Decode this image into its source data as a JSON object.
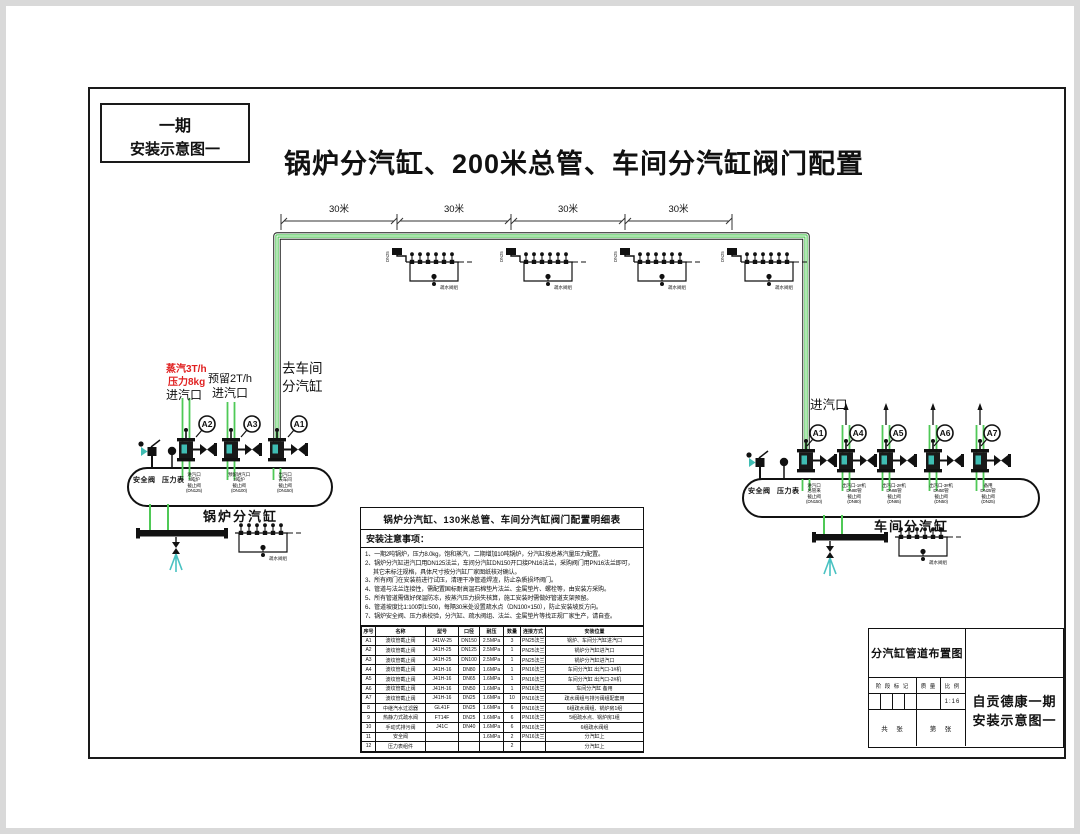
{
  "page": {
    "phase_box": {
      "line1": "一期",
      "line2": "安装示意图一"
    },
    "main_title": "锅炉分汽缸、200米总管、车间分汽缸阀门配置"
  },
  "colors": {
    "pipe_green": "#4fc956",
    "pipe_light": "#eef9ee",
    "teal": "#3fbdb3",
    "red": "#e02020",
    "line": "#1a1a1a"
  },
  "main_pipe": {
    "segments": [
      "30米",
      "30米",
      "30米",
      "30米"
    ],
    "tap_dn": "DN25",
    "trap_label": "疏水阀组"
  },
  "boiler_drum": {
    "label": "锅炉分汽缸",
    "safety_valve": "安全阀",
    "pressure_gauge": "压力表",
    "inlet1": {
      "red1": "蒸汽3T/h",
      "red2": "压力8kg",
      "label": "进汽口",
      "valve_tag": "A2"
    },
    "inlet2": {
      "line1": "预留2T/h",
      "line2": "进汽口",
      "valve_tag": "A3"
    },
    "outlet": {
      "line1": "去车间",
      "line2": "分汽缸",
      "valve_tag": "A1"
    },
    "nozzles": [
      [
        "进汽口",
        "3吨炉",
        "截止阀",
        "(DN125)"
      ],
      [
        "预留进汽口",
        "2吨炉",
        "截止阀",
        "(DN100)"
      ],
      [
        "出汽口",
        "去车间",
        "截止阀",
        "(DN150)"
      ]
    ],
    "trap_label": "疏水阀组"
  },
  "workshop_drum": {
    "label": "车间分汽缸",
    "inlet_label": "进汽口",
    "safety_valve": "安全阀",
    "pressure_gauge": "压力表",
    "valve_tags": [
      "A1",
      "A4",
      "A5",
      "A6",
      "A7"
    ],
    "nozzles": [
      [
        "进汽口",
        "总管来",
        "截止阀",
        "(DN150)"
      ],
      [
        "出汽口-1#机",
        "DN80管",
        "截止阀",
        "(DN80)"
      ],
      [
        "出汽口-2#机",
        "DN65管",
        "截止阀",
        "(DN65)"
      ],
      [
        "出汽口-3#机",
        "DN50管",
        "截止阀",
        "(DN50)"
      ],
      [
        "备用",
        "DN25管",
        "截止阀",
        "(DN25)"
      ]
    ],
    "trap_label": "疏水阀组"
  },
  "notes_table": {
    "title": "锅炉分汽缸、130米总管、车间分汽缸阀门配置明细表",
    "notes_header": "安装注意事项：",
    "notes": [
      "1、一期2吨锅炉，压力8.0kg，饱和蒸汽，二期增加10吨锅炉，分汽缸按总蒸汽量压力配置。",
      "2、锅炉分汽缸进汽口用DN125法兰，车间分汽缸DN150开口接PN16法兰，采购阀门用PN16法兰即可，其它未标注规格，具体尺寸按分汽缸厂家图纸核对确认。",
      "3、所有阀门在安装前进行试压，清理干净管道焊渣，防止杂质损坏阀门。",
      "4、管道与法兰连接性，需配置国标耐高温石棉垫片法兰、金属垫片、螺栓等，由安装方采购。",
      "5、所有管道需做好保温防冻，按蒸汽压力损失核算，施工安装时需做好管道支架预留。",
      "6、管道坡度比1:100到1:500，每隔30米处设置疏水点（DN100×150），防止安装坡反方向。",
      "7、锅炉安全阀、压力表校验，分汽缸、疏水阀组、法兰、金属垫片等找正规厂家生产，请自查。"
    ]
  },
  "schedule": {
    "headers": [
      "序号",
      "名称",
      "型号",
      "口径",
      "耐压",
      "数量",
      "连接方式",
      "安装位置"
    ],
    "rows": [
      [
        "A1",
        "波纹管截止阀",
        "J41W-25",
        "DN150",
        "2.5MPa",
        "3",
        "PN25法兰",
        "锅炉、车间分汽缸进汽口"
      ],
      [
        "A2",
        "波纹管截止阀",
        "J41H-25",
        "DN125",
        "2.5MPa",
        "1",
        "PN25法兰",
        "锅炉分汽缸进汽口"
      ],
      [
        "A3",
        "波纹管截止阀",
        "J41H-25",
        "DN100",
        "2.5MPa",
        "1",
        "PN25法兰",
        "锅炉分汽缸进汽口"
      ],
      [
        "A4",
        "波纹管截止阀",
        "J41H-16",
        "DN80",
        "1.6MPa",
        "1",
        "PN16法兰",
        "车间分汽缸 出汽口-1#机"
      ],
      [
        "A5",
        "波纹管截止阀",
        "J41H-16",
        "DN65",
        "1.6MPa",
        "1",
        "PN16法兰",
        "车间分汽缸 出汽口-2#机"
      ],
      [
        "A6",
        "波纹管截止阀",
        "J41H-16",
        "DN50",
        "1.6MPa",
        "1",
        "PN16法兰",
        "车间分汽缸 备用"
      ],
      [
        "A7",
        "波纹管截止阀",
        "J41H-16",
        "DN25",
        "1.6MPa",
        "10",
        "PN16法兰",
        "疏水阀组与排污阀组配套用"
      ],
      [
        "8",
        "中继汽水过滤器",
        "GL41F",
        "DN25",
        "1.6MPa",
        "6",
        "PN16法兰",
        "6组疏水阀组、锅炉房1组"
      ],
      [
        "9",
        "热静力式疏水阀",
        "FT14F",
        "DN25",
        "1.6MPa",
        "6",
        "PN16法兰",
        "5组疏水点、锅炉房1组"
      ],
      [
        "10",
        "手动式排污阀",
        "J41C",
        "DN40",
        "1.6MPa",
        "6",
        "PN16法兰",
        "6组疏水阀组"
      ],
      [
        "11",
        "安全阀",
        "",
        "",
        "1.6MPa",
        "2",
        "PN16法兰",
        "分汽缸上"
      ],
      [
        "12",
        "压力表组件",
        "",
        "",
        "",
        "2",
        "",
        "分汽缸上"
      ]
    ]
  },
  "title_block": {
    "drawing_name": "分汽缸管道布置图",
    "stage_label": "阶 段 标 记",
    "mass_label": "质 量",
    "scale_label": "比 例",
    "scale_value": "1:16",
    "sheet_total_label": "共　张",
    "sheet_no_label": "第　张",
    "project_line1": "自贡德康一期",
    "project_line2": "安装示意图一"
  }
}
